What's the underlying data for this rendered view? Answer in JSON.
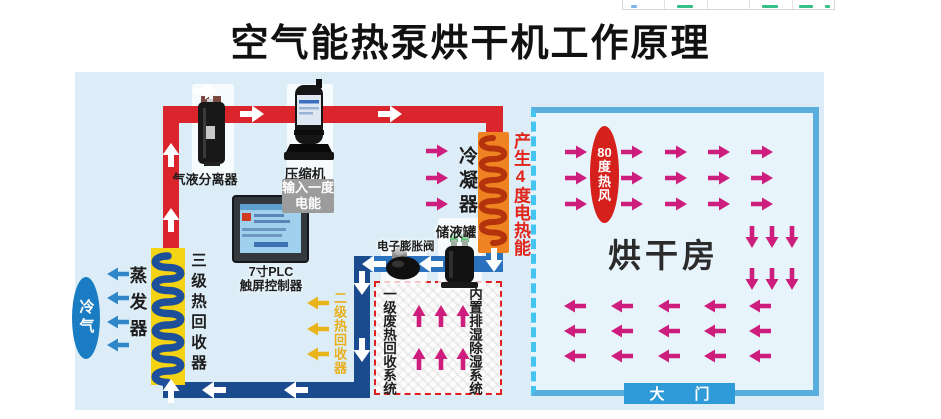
{
  "title": "空气能热泵烘干机工作原理",
  "components": {
    "separator": "气液分离器",
    "compressor": "压缩机",
    "input_energy": "输入一度电能",
    "condenser": "冷凝器",
    "heat_output": "产生4度电热能",
    "tank": "储液罐",
    "expansion_valve": "电子膨胀阀",
    "plc_line1": "7寸PLC",
    "plc_line2": "触屏控制器",
    "recovery3": "三级热回收器",
    "evaporator": "蒸发器",
    "cold_air": "冷气",
    "recovery2": "二级热回收器",
    "waste_recovery": "一级废热回收系统",
    "dehumidifier": "内置排湿除湿系统"
  },
  "room": {
    "name": "烘干房",
    "hot_wind": "80度热风",
    "door": "大门"
  },
  "colors": {
    "hot_pipe": "#d9252b",
    "cold_pipe": "#1b4b8f",
    "liquid_pipe": "#2a72be",
    "hot_air_arrow": "#ce1e7d",
    "cold_air_arrow": "#2f87ca",
    "recovery_arrow": "#e9b31c",
    "diagram_background": "#dcedf7",
    "room_background": "#e8f4fc"
  }
}
